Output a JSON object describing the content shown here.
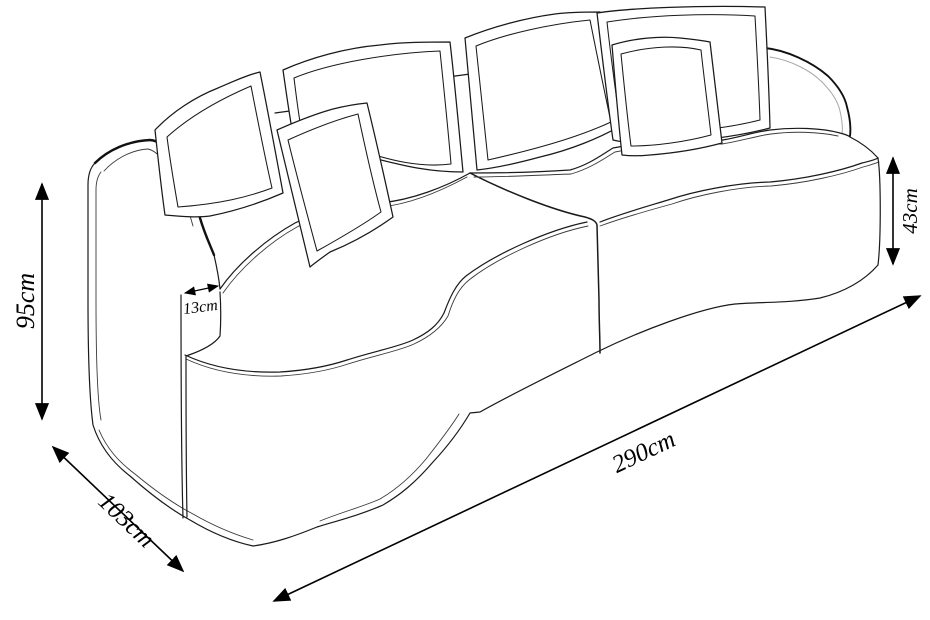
{
  "figure": {
    "subject": "curved sofa technical line drawing with dimensions",
    "background_color": "#ffffff",
    "line_color": "#1a1a1a"
  },
  "dimensions": {
    "height": {
      "label": "95cm"
    },
    "depth": {
      "label": "103cm"
    },
    "width": {
      "label": "290cm"
    },
    "seat_height": {
      "label": "43cm"
    },
    "armrest_width": {
      "label": "13cm"
    }
  }
}
